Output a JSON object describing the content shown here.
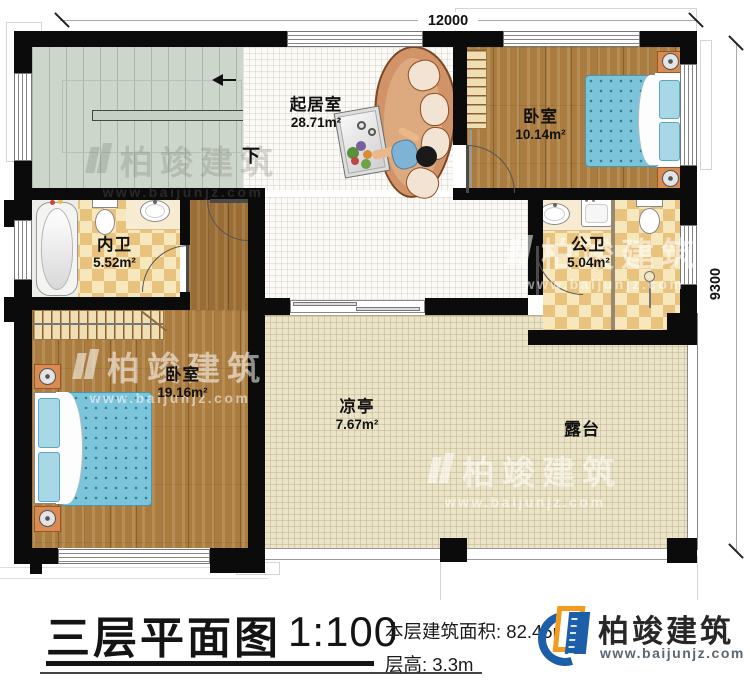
{
  "plan": {
    "dim_top": "12000",
    "dim_right": "9300",
    "down_label": "下",
    "rooms": [
      {
        "name": "起居室",
        "area": "28.71m²"
      },
      {
        "name": "卧室",
        "area": "10.14m²"
      },
      {
        "name": "内卫",
        "area": "5.52m²"
      },
      {
        "name": "公卫",
        "area": "5.04m²"
      },
      {
        "name": "卧室",
        "area": "19.16m²"
      },
      {
        "name": "凉亭",
        "area": "7.67m²"
      },
      {
        "name": "露台",
        "area": ""
      }
    ],
    "watermark": {
      "brand": "柏竣建筑",
      "url": "www.baijunjz.com"
    }
  },
  "titlebar": {
    "title": "三层平面图",
    "scale": "1:100",
    "area_label": "本层建筑面积:",
    "area_value": "82.45m²",
    "floor_height_label": "层高:",
    "floor_height_value": "3.3m",
    "logo_brand": "柏竣建筑",
    "logo_url": "www.baijunjz.com"
  },
  "colors": {
    "wall": "#0b0b0b",
    "wood_floor": "#aa7c3f",
    "checker_tile": "#e9c37e",
    "terrace_tile": "#ebe4c8",
    "stair": "#ccd6ca",
    "bed_blue": "#7cc4da",
    "sofa_tan": "#d19368",
    "logo_blue": "#1c5fa8",
    "logo_orange": "#f29b1d"
  }
}
